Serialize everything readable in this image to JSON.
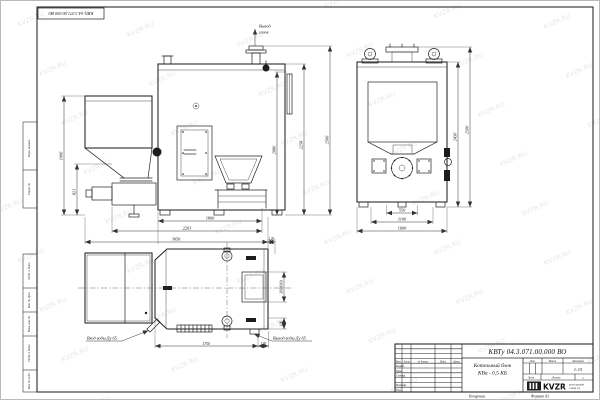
{
  "sheet": {
    "watermark": "KVZR.RU",
    "stamp_top_left": "КВТу 04.3.071.00.000 ВО",
    "copied_label": "Копировал",
    "format_label": "Формат А3",
    "margin_labels": [
      "Перв. примен.",
      "Справ. №",
      "Подп. и дата",
      "Инв. № дубл.",
      "Взам. инв. №",
      "Подп. и дата",
      "Инв. № подл."
    ]
  },
  "views": {
    "side": {
      "gas_outlet_line1": "Выход",
      "gas_outlet_line2": "газов",
      "dim_left_height": "1900",
      "dim_left_feeder": "821",
      "dim_bottom_inner": "1800",
      "dim_bottom_mid": "2263",
      "dim_bottom_outer": "3050",
      "dim_right_inner": "2086",
      "dim_right_mid": "2258",
      "dim_right_outer": "2500"
    },
    "front": {
      "dim_bottom_inner": "550",
      "dim_bottom_mid": "1100",
      "dim_bottom_outer": "1600",
      "dim_right_inner": "2430",
      "dim_right_outer": "2500"
    },
    "plan": {
      "water_in_label": "Вход воды Ду 65",
      "water_out_label": "Выход воды Ду 65",
      "dim_length": "1750",
      "dim_offset": "195",
      "dim_top": "120",
      "dim_chimney": "200(600)",
      "dim_right_small": "100"
    }
  },
  "title_block": {
    "doc_number": "КВТу 04.3.071.00.000 ВО",
    "product_name_line1": "Котельный блок",
    "product_name_line2": "КВа - 0,5 КБ",
    "header_cols": {
      "izm": "Изм.",
      "list": "Лист",
      "dokum": "№ докум.",
      "podp": "Подп.",
      "data": "Дата"
    },
    "rows": {
      "razrab": "Разраб.",
      "prov": "Пров.",
      "tkontr": "Т.контр.",
      "nkontr": "Н.контр.",
      "utv": "Утв."
    },
    "lit_label": "Лит.",
    "massa_label": "Масса",
    "masshtab_label": "Масштаб",
    "scale_value": "1:15",
    "list_label": "Лист",
    "listov_label": "Листов",
    "listov_value": "1",
    "logo_text": "KVZR",
    "logo_sub_line1": "КОТЕЛЬНЫЙ",
    "logo_sub_line2": "ЗАВОД РФ"
  }
}
